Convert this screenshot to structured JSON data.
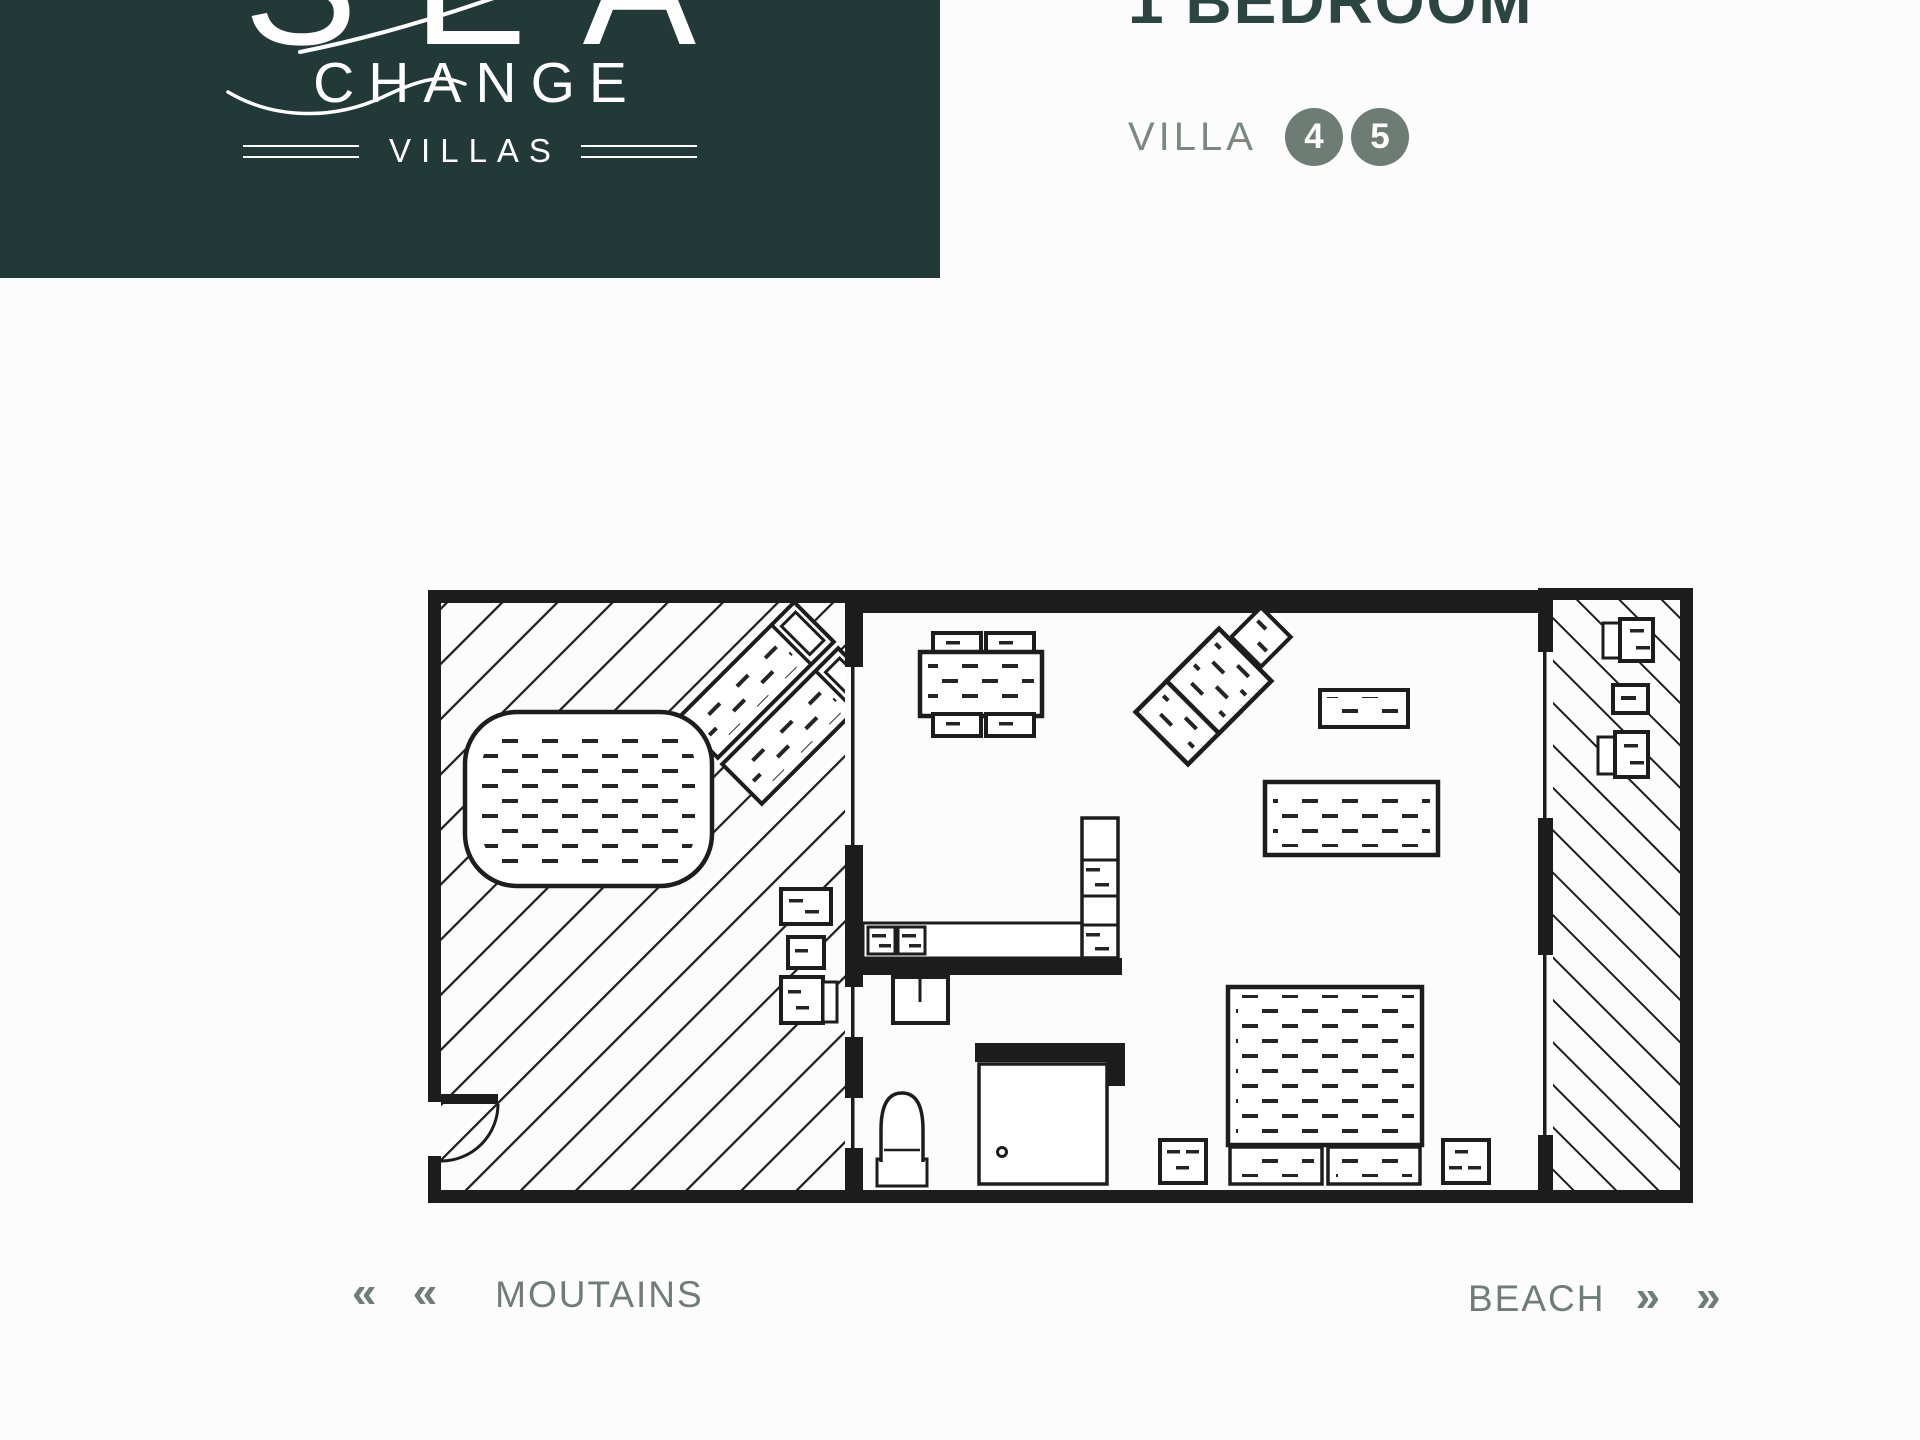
{
  "window": {
    "width": 1920,
    "height": 1440,
    "background": "#fcfcfc"
  },
  "logo": {
    "word_top": "SEA",
    "word_middle": "CHANGE",
    "word_bottom": "VILLAS",
    "background_color": "#223a37",
    "text_color": "#ffffff"
  },
  "header": {
    "title": "1 BEDROOM",
    "title_color": "#2b4540",
    "villa_label": "VILLA",
    "villa_numbers": [
      "4",
      "5"
    ],
    "label_color": "#7b8781",
    "badge_color": "#6e7c76"
  },
  "plan": {
    "line_color": "#1d1d1d"
  },
  "footer": {
    "left_arrows": "« «",
    "left_label": "MOUTAINS",
    "right_label": "BEACH",
    "right_arrows": "» »",
    "text_color": "#6e7d77"
  }
}
